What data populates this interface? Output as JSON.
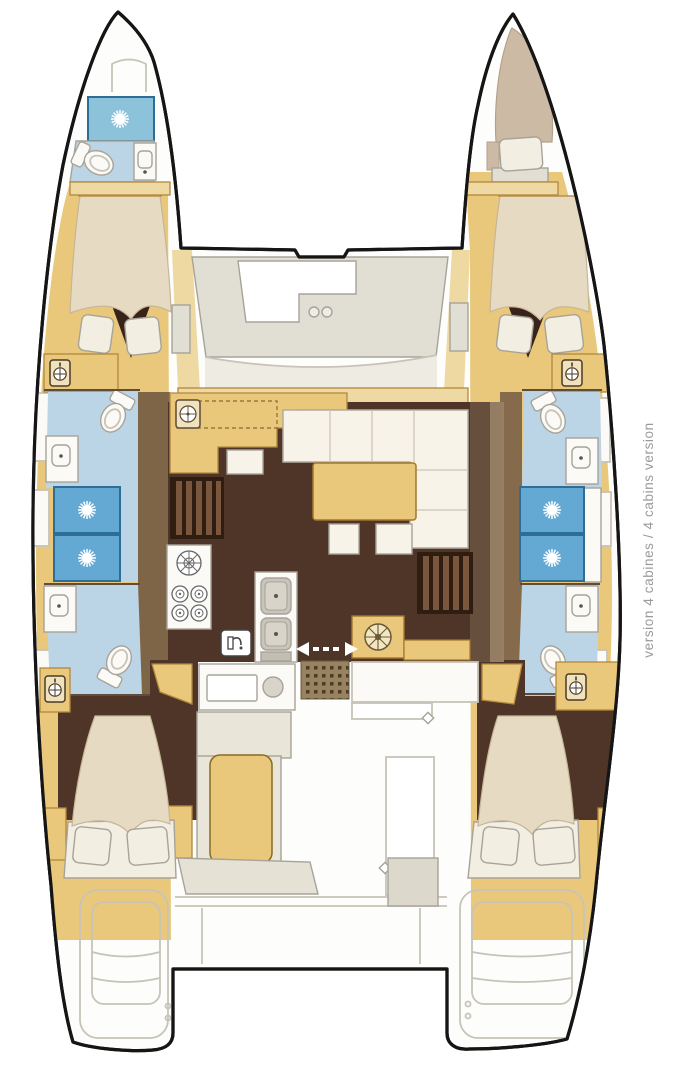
{
  "caption": {
    "text": "version 4 cabines / 4 cabins version"
  },
  "plan": {
    "type": "catamaran-floorplan",
    "cabins_label": "4"
  },
  "colors": {
    "page_bg": "#ffffff",
    "boat_white": "#fdfdfc",
    "outline": "#151515",
    "wood": "#e9c87c",
    "wood_light": "#eed9a2",
    "wood_dark": "#b2883c",
    "floor_dark": "#4e3528",
    "floor_darker": "#38231a",
    "shower_blue": "#63a9d3",
    "shower_fore": "#8cc2da",
    "shower_edge": "#2e6e96",
    "bath_blue": "#bcd5e6",
    "mattress": "#e6dbc2",
    "mattress_line": "#c6b697",
    "pillow": "#f2eee2",
    "sofa": "#f7f3e9",
    "deck_gray": "#e1ded4",
    "deck_gray2": "#edebe2",
    "taupe": "#6b5440",
    "taupe_light": "#a89274",
    "unit_white": "#fbfaf6",
    "basin_gray": "#c9c5bb",
    "line_gray": "#a7a399",
    "line_gray2": "#c7c3b7",
    "wall_dark": "#5f4c3a",
    "steps_base": "#2f1d12",
    "steps_rib": "#7a573c",
    "mat_base": "#97835f",
    "mat_dot": "#4e3c26",
    "caption_gray": "#9a9a9a"
  }
}
